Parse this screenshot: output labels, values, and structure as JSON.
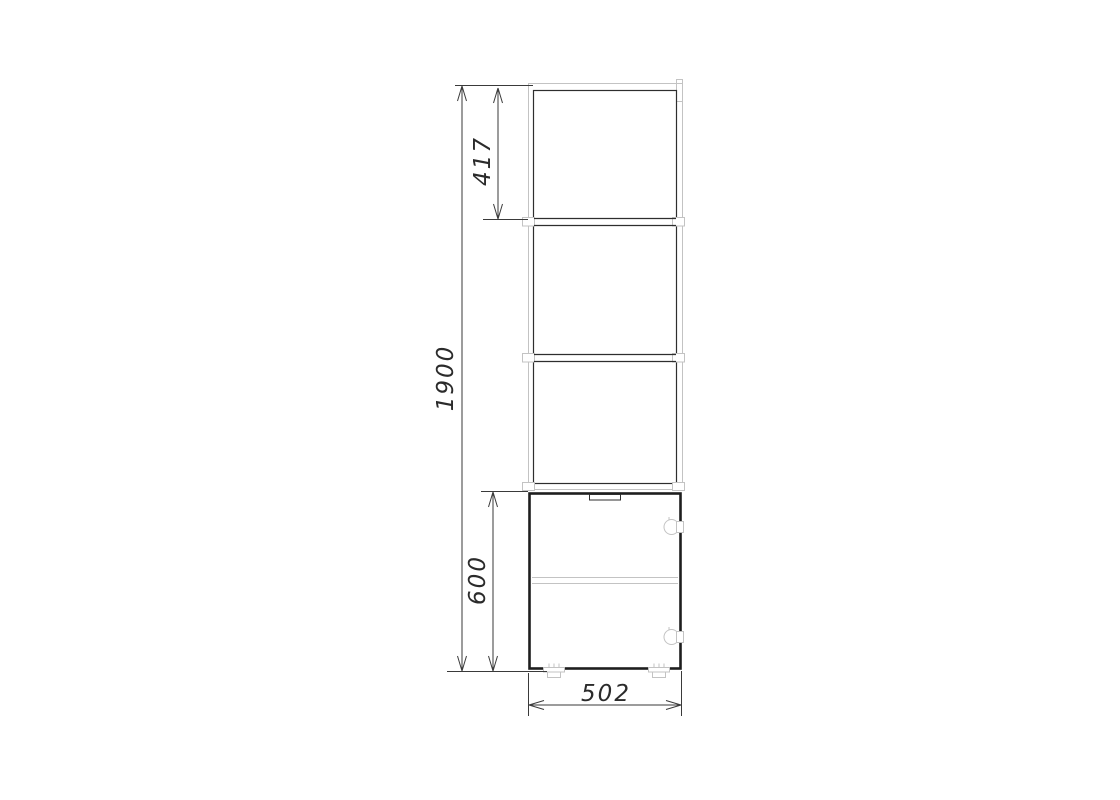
{
  "drawing": {
    "dimensions": {
      "overall_height": "1900",
      "top_section_height": "417",
      "base_cabinet_height": "600",
      "overall_width": "502"
    },
    "colors": {
      "background": "#ffffff",
      "bold_line": "#1e1e1e",
      "dark_line": "#2e2e2e",
      "light_line": "#c3c3c3",
      "dimension_line": "#3a3a3a",
      "text": "#2b2b2b"
    }
  }
}
